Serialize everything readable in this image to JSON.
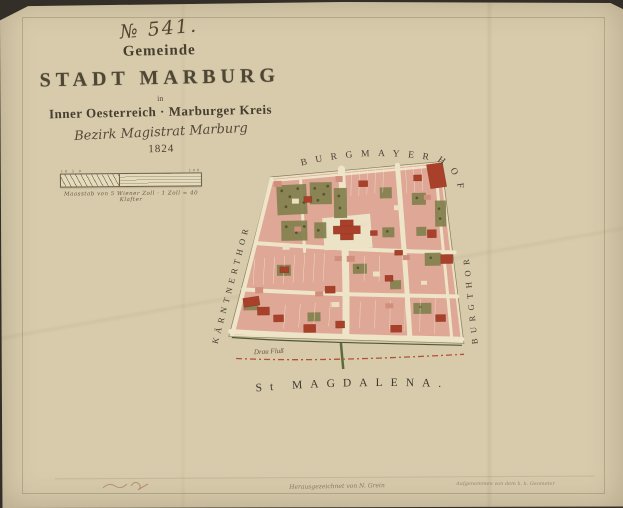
{
  "document": {
    "sheet_number": "№ 541.",
    "title_block": {
      "gemeinde": "Gemeinde",
      "main_title": "STADT MARBURG",
      "in_word": "in",
      "region_line": "Inner Oesterreich · Marburger Kreis",
      "district_line": "Bezirk Magistrat Marburg",
      "year": "1824"
    },
    "scale_bar": {
      "ticks_left": "10 5 0",
      "ticks_right": "100",
      "caption": "Maasstab von 5 Wiener Zoll · 1 Zoll = 40 Klafter"
    },
    "map_labels": {
      "top_arc": "BURGMAYERHOF",
      "left_edge": "KÄRNTNERTHOR",
      "right_edge": "BURGTHOR",
      "bottom": "St MAGDALENA.",
      "river": "Drau Fluß"
    },
    "footer": {
      "center_inscription": "Herausgezeichnet von N. Grein",
      "right_inscription": "Aufgenommen von dem k. k. Geometer"
    },
    "colors": {
      "parchment": "#d7cbac",
      "street_cream": "#ece2c6",
      "building_pink": "#dfa795",
      "building_red": "#a8402a",
      "garden_green": "#83814e",
      "river_line_red": "#b35233",
      "ink": "#484134"
    }
  }
}
